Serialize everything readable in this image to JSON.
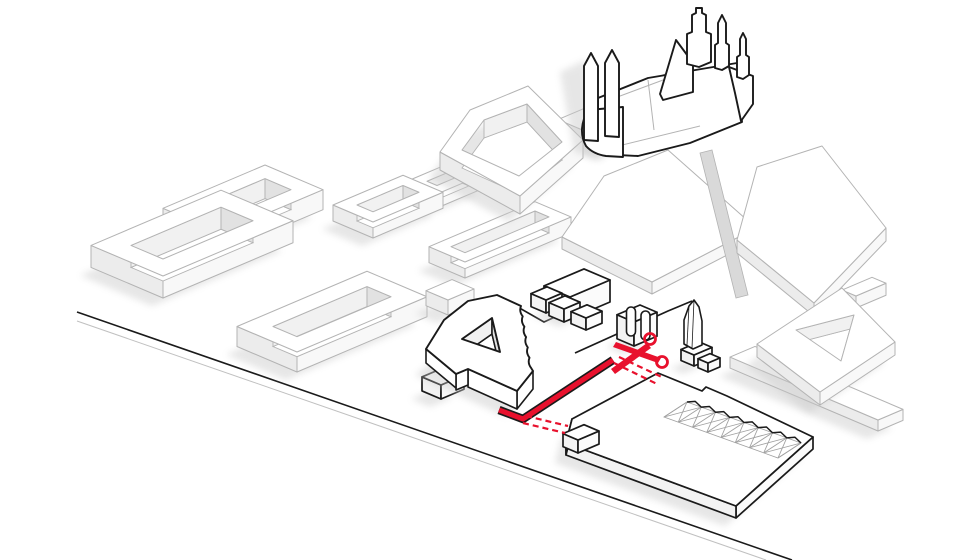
{
  "diagram": {
    "name": "urban-demolition-axonometric-diagram",
    "canvas": {
      "width": 975,
      "height": 560,
      "background": "#ffffff"
    },
    "palette": {
      "ghost_stroke": "#b3b3b3",
      "black": "#1a1a1a",
      "red": "#e8112d",
      "red_dark": "#b50d22",
      "top": "#ffffff",
      "face_sw": "#ececec",
      "face_se": "#f8f8f8",
      "black_face_sw": "#f3f3f3",
      "black_face_se": "#fbfbfb",
      "wall_nw": "#f1f1f1",
      "wall_ne": "#e2e2e2",
      "floor": "#ffffff",
      "shadow": "#c9c9c9",
      "truss": "#a0a0a0",
      "gap": "#d9d9d9",
      "street_gray": "#c0c0c0"
    },
    "street": {
      "black_line": [
        [
          77,
          312
        ],
        [
          792,
          560
        ]
      ],
      "gray_line": [
        [
          77,
          321
        ],
        [
          766,
          560
        ]
      ]
    },
    "ghost_blocks": [
      {
        "name": "courtyard-block-a",
        "kind": "ring",
        "s": [
          221,
          233
        ],
        "lu": 58,
        "lv": 102,
        "h": 20,
        "m": 16,
        "shadow": true
      },
      {
        "name": "small-courtyard-block",
        "kind": "ring",
        "s": [
          437,
          194
        ],
        "lu": 30,
        "lv": 52,
        "h": 14,
        "m": 10,
        "shadow": true
      },
      {
        "name": "courtyard-block-c",
        "kind": "ring",
        "s": [
          373,
          222
        ],
        "lu": 40,
        "lv": 70,
        "h": 16,
        "m": 12,
        "shadow": true
      },
      {
        "name": "cathedral-platform",
        "kind": "prism",
        "s": [
          606,
          140
        ],
        "lu": 48,
        "lv": 112,
        "h": 12,
        "shadow": true
      },
      {
        "name": "courtyard-block-b",
        "kind": "ring",
        "s": [
          163,
          276
        ],
        "lu": 72,
        "lv": 130,
        "h": 22,
        "m": 20,
        "shadow": true
      },
      {
        "name": "slim-courtyard-block",
        "kind": "ring",
        "s": [
          465,
          262
        ],
        "lu": 36,
        "lv": 106,
        "h": 16,
        "m": 11,
        "shadow": true
      },
      {
        "name": "courtyard-block-x",
        "kind": "ring",
        "s": [
          297,
          352
        ],
        "lu": 60,
        "lv": 130,
        "h": 20,
        "m": 18,
        "shadow": true
      },
      {
        "name": "ghost-box",
        "kind": "prism",
        "s": [
          448,
          300
        ],
        "lu": 22,
        "lv": 26,
        "h": 15,
        "shadow": true
      },
      {
        "name": "long-bar-slab",
        "kind": "prism",
        "s": [
          878,
          420
        ],
        "lu": 148,
        "lv": 25,
        "h": 11,
        "shadow": true
      },
      {
        "name": "triangle-arm",
        "kind": "prism",
        "s": [
          856,
          296
        ],
        "lu": 14,
        "lv": 30,
        "h": 12
      }
    ],
    "ghost_custom": [
      {
        "name": "pentagon-courtyard-block",
        "kind": "polyring",
        "outer": [
          [
            440,
            152
          ],
          [
            470,
            110
          ],
          [
            528,
            86
          ],
          [
            583,
            140
          ],
          [
            520,
            196
          ]
        ],
        "inner": [
          [
            462,
            150
          ],
          [
            484,
            120
          ],
          [
            527,
            104
          ],
          [
            562,
            142
          ],
          [
            519,
            176
          ]
        ],
        "h": 18,
        "faceEdges": [
          [
            3,
            4
          ],
          [
            4,
            0
          ]
        ],
        "wallEdges": [
          [
            1,
            2
          ],
          [
            2,
            3
          ]
        ],
        "shadow": true
      },
      {
        "name": "plaza-slab-west",
        "kind": "polyprism",
        "top": [
          [
            562,
            237
          ],
          [
            604,
            176
          ],
          [
            668,
            150
          ],
          [
            756,
            228
          ],
          [
            652,
            282
          ]
        ],
        "h": 12,
        "faceEdges": [
          [
            3,
            4
          ],
          [
            4,
            0
          ]
        ]
      },
      {
        "name": "plaza-gap-wedge",
        "kind": "flatpoly",
        "pts": [
          [
            700,
            153
          ],
          [
            712,
            150
          ],
          [
            748,
            295
          ],
          [
            736,
            298
          ]
        ],
        "fill": "#d9d9d9"
      },
      {
        "name": "plaza-slab-east",
        "kind": "polyprism",
        "top": [
          [
            737,
            240
          ],
          [
            757,
            167
          ],
          [
            822,
            146
          ],
          [
            886,
            228
          ],
          [
            814,
            303
          ]
        ],
        "h": 13,
        "faceEdges": [
          [
            3,
            4
          ],
          [
            4,
            0
          ]
        ]
      },
      {
        "name": "triangle-courtyard-block",
        "kind": "polyring",
        "outer": [
          [
            757,
            344
          ],
          [
            842,
            288
          ],
          [
            895,
            342
          ],
          [
            820,
            392
          ]
        ],
        "inner": [
          [
            796,
            330
          ],
          [
            854,
            315
          ],
          [
            841,
            361
          ]
        ],
        "h": 13,
        "faceEdges": [
          [
            2,
            3
          ],
          [
            3,
            0
          ]
        ],
        "wallEdges": [
          [
            0,
            1
          ],
          [
            1,
            2
          ]
        ],
        "shadow": true
      }
    ],
    "site": {
      "ground_lines": [
        {
          "name": "plot-edge-west",
          "pts": [
            [
              502,
              298
            ],
            [
              544,
              322
            ],
            [
              603,
              295
            ]
          ]
        },
        {
          "name": "plot-edge-plaza",
          "pts": [
            [
              575,
              353
            ],
            [
              668,
              311
            ],
            [
              692,
              301
            ]
          ]
        }
      ],
      "big_slab": {
        "name": "site-slab",
        "kind": "polyprism",
        "top": [
          [
            572,
            419
          ],
          [
            658,
            373
          ],
          [
            702,
            391
          ],
          [
            706,
            387
          ],
          [
            727,
            396
          ],
          [
            813,
            437
          ],
          [
            736,
            506
          ],
          [
            566,
            443
          ]
        ],
        "h": 12,
        "faceEdges": [
          [
            5,
            6
          ],
          [
            6,
            7
          ],
          [
            7,
            0
          ]
        ],
        "shadow": true
      },
      "boxes": [
        {
          "name": "cluster-hall",
          "s": [
            570,
            297
          ],
          "lu": 26,
          "lv": 40,
          "h": 22,
          "shadow": true
        },
        {
          "name": "cluster-cube-1",
          "s": [
            546,
            300
          ],
          "lu": 15,
          "lv": 16,
          "h": 13
        },
        {
          "name": "cluster-cube-2",
          "s": [
            564,
            309
          ],
          "lu": 15,
          "lv": 16,
          "h": 13
        },
        {
          "name": "cluster-cube-3",
          "s": [
            586,
            318
          ],
          "lu": 15,
          "lv": 16,
          "h": 12
        },
        {
          "name": "gate-pavilion",
          "s": [
            634,
            322
          ],
          "lu": 17,
          "lv": 23,
          "h": 24,
          "shadow": true
        },
        {
          "name": "obelisk-base",
          "s": [
            694,
            355
          ],
          "lu": 13,
          "lv": 18,
          "h": 11,
          "shadow": true
        },
        {
          "name": "obelisk-side-box",
          "s": [
            708,
            363
          ],
          "lu": 10,
          "lv": 12,
          "h": 9
        },
        {
          "name": "wall-box-1",
          "s": [
            458,
            355
          ],
          "lu": 18,
          "lv": 22,
          "h": 14,
          "shadow": true
        },
        {
          "name": "wall-box-2",
          "s": [
            441,
            385
          ],
          "lu": 19,
          "lv": 23,
          "h": 14,
          "shadow": true
        },
        {
          "name": "gatehouse-box",
          "s": [
            578,
            440
          ],
          "lu": 15,
          "lv": 21,
          "h": 13
        }
      ],
      "gate_columns": [
        {
          "x": 626.5,
          "y": 307,
          "w": 9,
          "h": 29
        },
        {
          "x": 641,
          "y": 311,
          "w": 9,
          "h": 29
        }
      ],
      "obelisk_path": "M 684 344 L 684 320 L 689 306 L 694 300 L 699 307 L 702 321 L 702 345 L 693 349 Z",
      "obelisk_facets": [
        "M 694 300 L 692 348",
        "M 689 306 L 687 345"
      ],
      "a_building": {
        "name": "stepped-courtyard-building",
        "top_path": "M 426 349 L 444 320 L 468 301 L 497 295 L 521 306 q -2.2 5.2 1.7 10.35 q -2.2 5.2 1.7 10.35 q -2.2 5.2 1.7 10.35 q -2.2 5.2 1.7 10.35 q -2.2 5.2 1.7 10.35 q -2.2 5.2 1.7 10.35 L 533 371 L 517 391 L 468 369 L 456 374 Z M 462 339 L 492 318 L 500 352 Z",
        "courtyard": {
          "floor": [
            [
              462,
              339
            ],
            [
              492,
              318
            ],
            [
              500,
              352
            ]
          ],
          "h": 16,
          "wallEdges": [
            [
              0,
              1
            ],
            [
              1,
              2
            ]
          ]
        },
        "faces": [
          {
            "a": [
              533,
              371
            ],
            "b": [
              517,
              391
            ],
            "h": 18
          },
          {
            "a": [
              517,
              391
            ],
            "b": [
              468,
              369
            ],
            "h": 18
          },
          {
            "a": [
              468,
              369
            ],
            "b": [
              456,
              374
            ],
            "h": 16
          },
          {
            "a": [
              456,
              374
            ],
            "b": [
              426,
              349
            ],
            "h": 14
          }
        ]
      },
      "sawtooth": {
        "name": "sawtooth-shed-roof",
        "a": [
          687,
          402
        ],
        "b": [
          801,
          443
        ],
        "d": [
          -23,
          15
        ],
        "teeth": 8,
        "jag": 3.2
      }
    },
    "red_cut": {
      "wall_pts": [
        [
          499,
          410
        ],
        [
          523,
          419
        ],
        [
          613,
          360
        ]
      ],
      "dash_pairs": [
        [
          [
            619,
            357
          ],
          [
            664,
            378
          ]
        ],
        [
          [
            614,
            363
          ],
          [
            657,
            384
          ]
        ],
        [
          [
            526,
            416
          ],
          [
            568,
            426
          ]
        ],
        [
          [
            523,
            423
          ],
          [
            565,
            433
          ]
        ]
      ],
      "scissors": {
        "rings": [
          [
            650,
            339
          ],
          [
            662,
            362
          ]
        ],
        "ring_r": 5.5,
        "blades": [
          [
            [
              647,
              343
            ],
            [
              611,
              369
            ],
            [
              615,
              374
            ],
            [
              651,
              348
            ]
          ],
          [
            [
              661,
              358
            ],
            [
              616,
              342
            ],
            [
              613,
              347
            ],
            [
              658,
              363
            ]
          ]
        ]
      }
    },
    "cathedral": {
      "name": "cathedral",
      "shadow_poly": [
        [
          560,
          72
        ],
        [
          585,
          60
        ],
        [
          602,
          160
        ],
        [
          574,
          152
        ]
      ],
      "shapes": [
        {
          "name": "cathedral-nave",
          "path": "M 598 154 L 598 98 L 648 78 L 737 63 L 742 122 L 690 143 L 638 156 Z"
        },
        {
          "name": "cathedral-wing",
          "path": "M 729 67 L 753 76 L 753 104 L 741 121 L 735 93 Z"
        },
        {
          "name": "cathedral-gable",
          "path": "M 660 94 L 676 40 L 693 63 L 693 92 L 663 100 Z"
        },
        {
          "name": "cathedral-central-tower",
          "path": "M 687 64 L 687 34 L 692 32 L 692 15 L 696 13 L 696 8 L 702 8 L 702 13 L 706 15 L 706 32 L 711 34 L 711 62 L 699 67 Z"
        },
        {
          "name": "cathedral-ne-tower-1",
          "path": "M 715 68 L 715 45 L 718 43 L 718 23 L 722 15 L 726 23 L 726 43 L 729 45 L 729 66 L 722 70 Z"
        },
        {
          "name": "cathedral-ne-tower-2",
          "path": "M 737 77 L 737 57 L 740 55 L 740 39 L 743 33 L 746 39 L 746 55 L 749 57 L 749 75 L 743 79 Z"
        },
        {
          "name": "cathedral-apse",
          "path": "M 588 110 Q 577 130 586 146 Q 593 154 606 156 L 623 157 L 623 107 Z"
        },
        {
          "name": "cathedral-west-spire-1",
          "path": "M 584 140 L 584 66 L 591 53 L 598 66 L 598 141 Z"
        },
        {
          "name": "cathedral-west-spire-2",
          "path": "M 605 136 L 605 63 L 612 50 L 619 63 L 619 137 Z"
        }
      ],
      "roof_lines": [
        [
          [
            604,
            102
          ],
          [
            690,
            70
          ]
        ],
        [
          [
            648,
            80
          ],
          [
            654,
            130
          ]
        ],
        [
          [
            610,
            148
          ],
          [
            700,
            126
          ]
        ]
      ]
    }
  }
}
